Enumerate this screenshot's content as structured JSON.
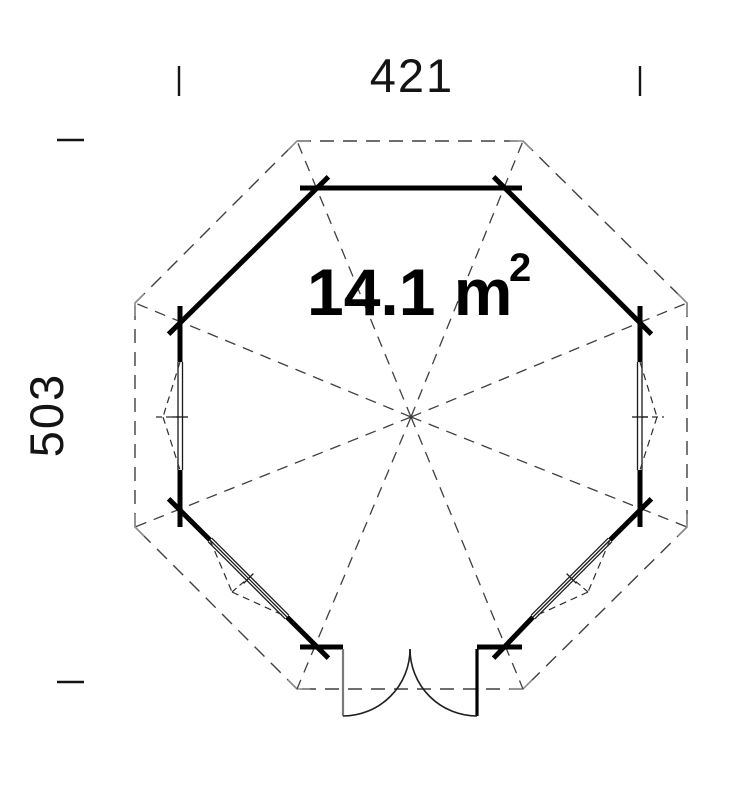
{
  "plan": {
    "name": "octagonal-summerhouse-floor-plan",
    "dimensions": {
      "width": "421",
      "height": "503"
    },
    "area": {
      "text": "14.1 m",
      "exponent": "2"
    },
    "colors": {
      "wall": "#000000",
      "dashed_line": "#3f3f3f",
      "corner_mark_gray": "#8c8c8c",
      "door_leaf_gray": "#7a7a7a",
      "text": "#141414",
      "background": "#ffffff"
    }
  }
}
